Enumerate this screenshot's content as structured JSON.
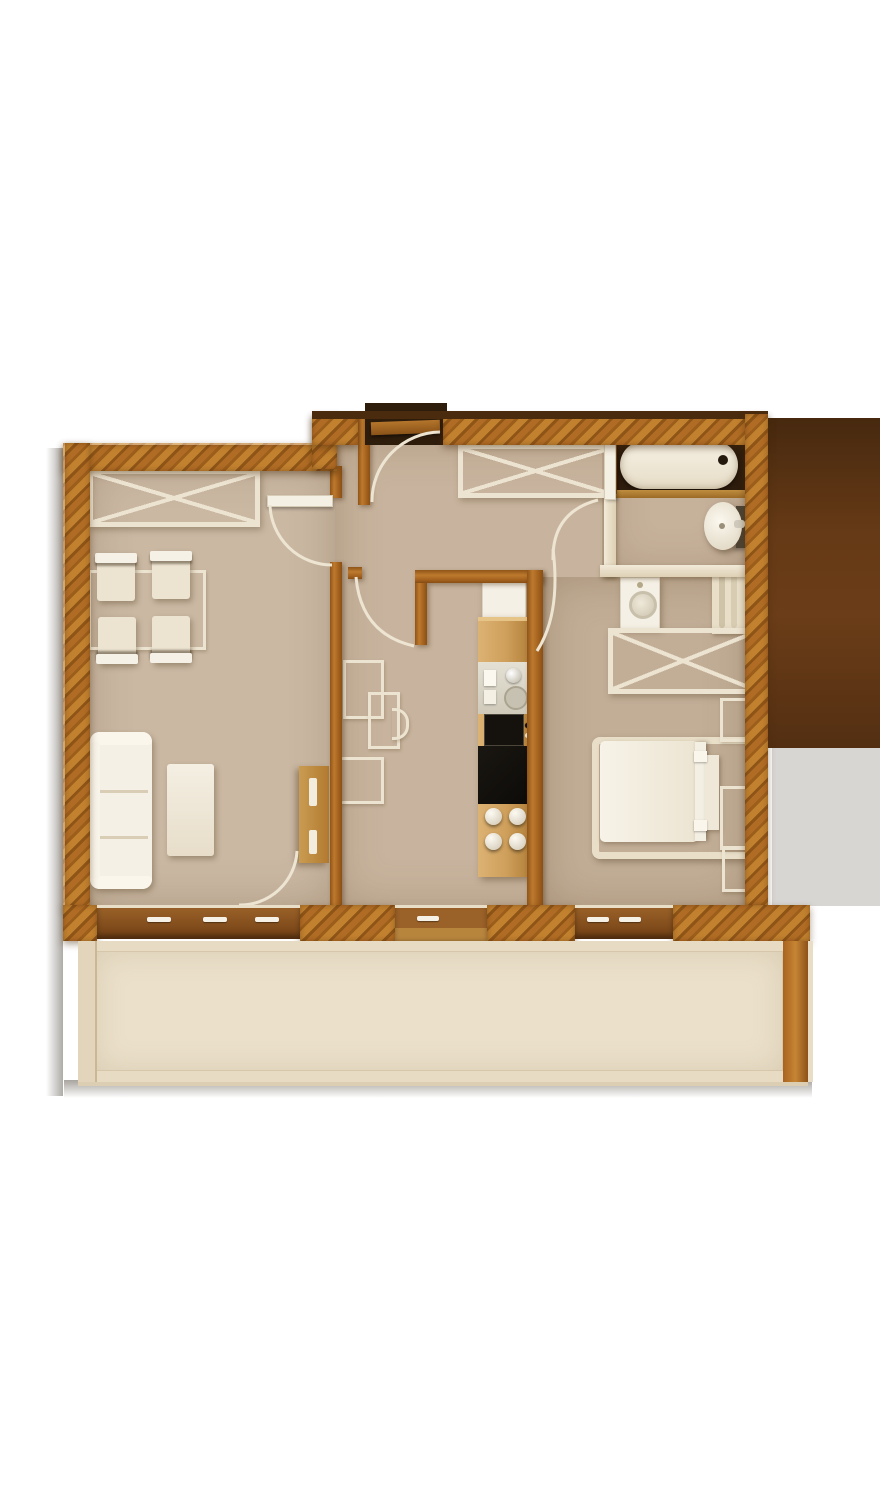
{
  "meta": {
    "description": "Top-down 3D rendered apartment floor plan, no text labels",
    "canvas": {
      "width": 880,
      "height": 1500
    },
    "plan_bounds": {
      "left": 63,
      "top": 404,
      "right": 812,
      "bottom": 1090
    }
  },
  "palette": {
    "page_bg": "#ffffff",
    "wall_hatch_light": "#c1812f",
    "wall_hatch_mid": "#b06c24",
    "wall_hatch_dark": "#8e5517",
    "wall_hatch_dark2": "#9c5e1b",
    "wall_top_shadow": "#4a2b0e",
    "interior_wood": "#a4621e",
    "counter_wood": "#d5aa68",
    "counter_wood_dark": "#b88a43",
    "floor_living": "#cab8a3",
    "floor_hall": "#c8b49e",
    "floor_bedroom": "#c2ae97",
    "floor_bathroom": "#c6b19b",
    "floor_balcony": "#e8dbc3",
    "balcony_inner": "#ebe0ca",
    "furniture_cream": "#ece3d0",
    "furniture_white": "#f5f0e5",
    "appliance_dark": "#15120d",
    "window_wood_dark": "#7c4b1c",
    "window_wood_light": "#a06a2c",
    "right_shadow_block": "#5d3516",
    "right_gray_block": "#d8d6d3",
    "arc_line": "#ede5d2",
    "tub_alcove": "#2e1c0c"
  },
  "rooms": [
    {
      "name": "living-room",
      "furniture": [
        "x-wardrobe",
        "dining-table",
        "dining-chairs x4",
        "sofa 3-seat",
        "coffee-table",
        "wood-side-cabinet",
        "window 3-sash",
        "swing-door to hallway",
        "swing-door rear"
      ]
    },
    {
      "name": "hallway",
      "furniture": [
        "entrance-door with vestibule recess",
        "x-wardrobe",
        "wireframe desk and chair",
        "balcony-door"
      ]
    },
    {
      "name": "kitchen",
      "furniture": [
        "fridge",
        "counter-column",
        "sink-module",
        "oven",
        "cooktop black",
        "control-knobs x4",
        "swing-door from hallway"
      ]
    },
    {
      "name": "bathroom",
      "furniture": [
        "bathtub in dark alcove",
        "round-washbasin wall-mounted",
        "swing-door"
      ]
    },
    {
      "name": "utility-niche",
      "furniture": [
        "washing-machine",
        "towel-radiator",
        "x-cabinet"
      ]
    },
    {
      "name": "bedroom",
      "furniture": [
        "double-bed with headboard",
        "wireframe-nightstands x3",
        "window 2-sash",
        "swing-door"
      ]
    },
    {
      "name": "balcony",
      "furniture": [
        "open terrace deck full width"
      ]
    }
  ],
  "windows": {
    "living_window_handles": 3,
    "hall_balcony_door_handles": 1,
    "bedroom_window_handles": 2
  },
  "counts": {
    "door_swing_arcs": 6,
    "dining_chairs": 4,
    "stove_knobs": 4,
    "x_symbol_cabinets": 3
  }
}
